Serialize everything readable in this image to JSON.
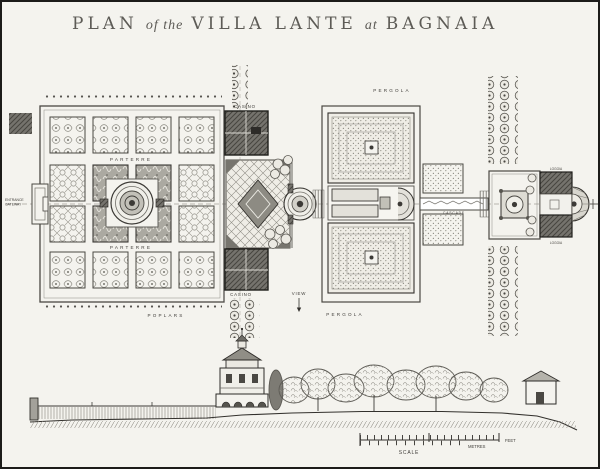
{
  "title": {
    "plan": "PLAN",
    "of_the": "of the",
    "villa_lante": "VILLA LANTE",
    "at": "at",
    "bagnaia": "BAGNAIA"
  },
  "labels": {
    "parterre_upper": "PARTERRE",
    "parterre_lower": "PARTERRE",
    "entrance_line1": "ENTRANCE",
    "entrance_line2": "GATEWAY",
    "casino_upper": "CASINO",
    "casino_lower": "CASINO",
    "view": "VIEW",
    "pergola_upper": "PERGOLA",
    "pergola_lower": "PERGOLA",
    "poplars": "POPLARS",
    "cascade": "CASCADE",
    "loggia_upper": "LOGGIA",
    "loggia_lower": "LOGGIA"
  },
  "scale_bar": {
    "scale": "SCALE",
    "feet": "FEET",
    "metres": "METRES"
  },
  "colors": {
    "paper": "#f4f3ee",
    "ink": "#33312d",
    "building_gray": "#6f6d67",
    "texture_gray": "#8a8880"
  }
}
